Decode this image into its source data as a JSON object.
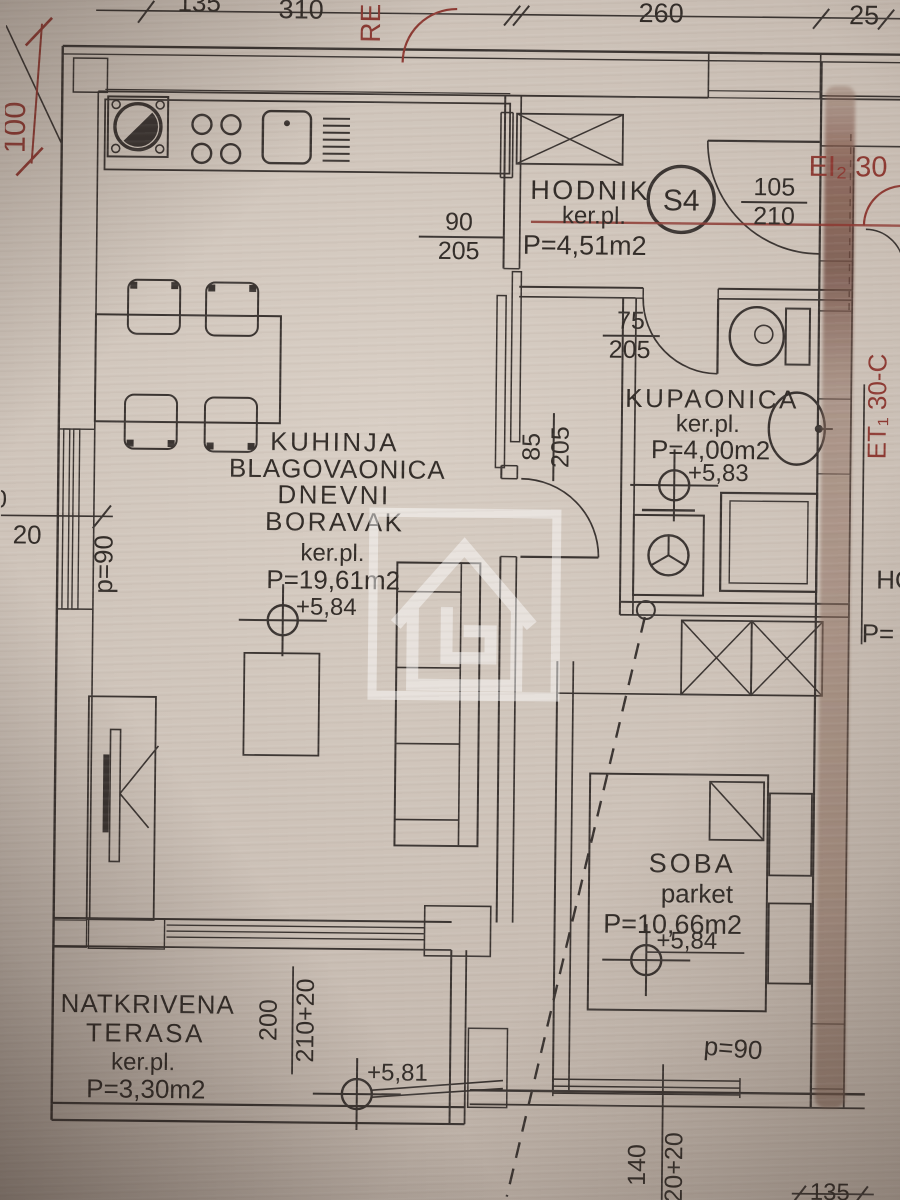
{
  "colors": {
    "paper": "#cbc0b6",
    "ink": "#3a3431",
    "red_annotation": "#8d3a33",
    "wall_highlight": "#8a6a5c",
    "watermark": "#ffffff"
  },
  "top_dims": {
    "cut": "135",
    "w1": "310",
    "w2": "260",
    "w3": "25"
  },
  "left_dims": {
    "height": "100",
    "win": "20",
    "cut": "0",
    "parapet": "p=90"
  },
  "fire_labels": {
    "rei": "RE",
    "ei": "EI₂ 30",
    "et": "ET₁ 30-C"
  },
  "hodnik": {
    "name": "HODNIK",
    "floor": "ker.pl.",
    "area": "P=4,51m2",
    "tag": "S4",
    "entry_door": {
      "w": "105",
      "h": "210"
    },
    "living_door": {
      "w": "90",
      "h": "205"
    }
  },
  "living": {
    "line1": "KUHINJA",
    "line2": "BLAGOVAONICA",
    "line3": "DNEVNI",
    "line4": "BORAVAK",
    "floor": "ker.pl.",
    "area": "P=19,61m2",
    "level": "+5,84"
  },
  "bathroom": {
    "name": "KUPAONICA",
    "floor": "ker.pl.",
    "area": "P=4,00m2",
    "level": "+5,83",
    "door": {
      "w": "75",
      "h": "205"
    }
  },
  "soba_door": {
    "w": "85",
    "h": "205"
  },
  "soba": {
    "name": "SOBA",
    "floor": "parket",
    "area": "P=10,66m2",
    "level": "+5,84",
    "parapet": "p=90",
    "window_dim_a": "140",
    "window_dim_b": "620+20",
    "dim": "135"
  },
  "terrace": {
    "line1": "NATKRIVENA",
    "line2": "TERASA",
    "floor": "ker.pl.",
    "area": "P=3,30m2",
    "level": "+5,81",
    "door_dim_a": "200",
    "door_dim_b": "210+20"
  },
  "neighbor": {
    "text1": "HO",
    "text2": "P="
  }
}
